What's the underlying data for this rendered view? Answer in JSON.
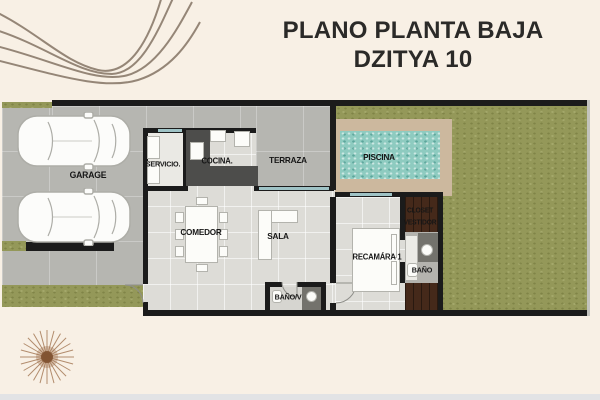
{
  "title": {
    "line1": "PLANO PLANTA BAJA",
    "line2": "DZITYA 10"
  },
  "rooms": {
    "garage": "GARAGE",
    "servicio": "SERVICIO.",
    "cocina": "COCINA.",
    "terraza": "TERRAZA",
    "piscina": "PISCINA",
    "comedor": "COMEDOR",
    "sala": "SALA",
    "bano_visitas": "BAÑO/V",
    "recamara": "RECAMÁRA 1",
    "closet_line1": "CLOSET",
    "closet_line2": "VESTIDOR",
    "bano": "BAÑO"
  },
  "decorations": {
    "top_left": "swirl-lines",
    "bottom_left": "sunburst"
  },
  "colors": {
    "background": "#f8f0e5",
    "wall": "#1b1b1b",
    "concrete": "#b6b6b1",
    "interior_tile": "#dddcd7",
    "grass": "#949859",
    "pool_water": "#8ecbc0",
    "pool_deck": "#ccb89e",
    "wood_floor": "#45291a",
    "counter_dark": "#4d4d4b",
    "sliding_door": "#9fc3c6",
    "decor_line": "#8b7b6c",
    "sunburst": "#9b6b45",
    "title_text": "#2b2a28",
    "label_text": "#161616",
    "bottom_strip": "#e2e3e5"
  }
}
